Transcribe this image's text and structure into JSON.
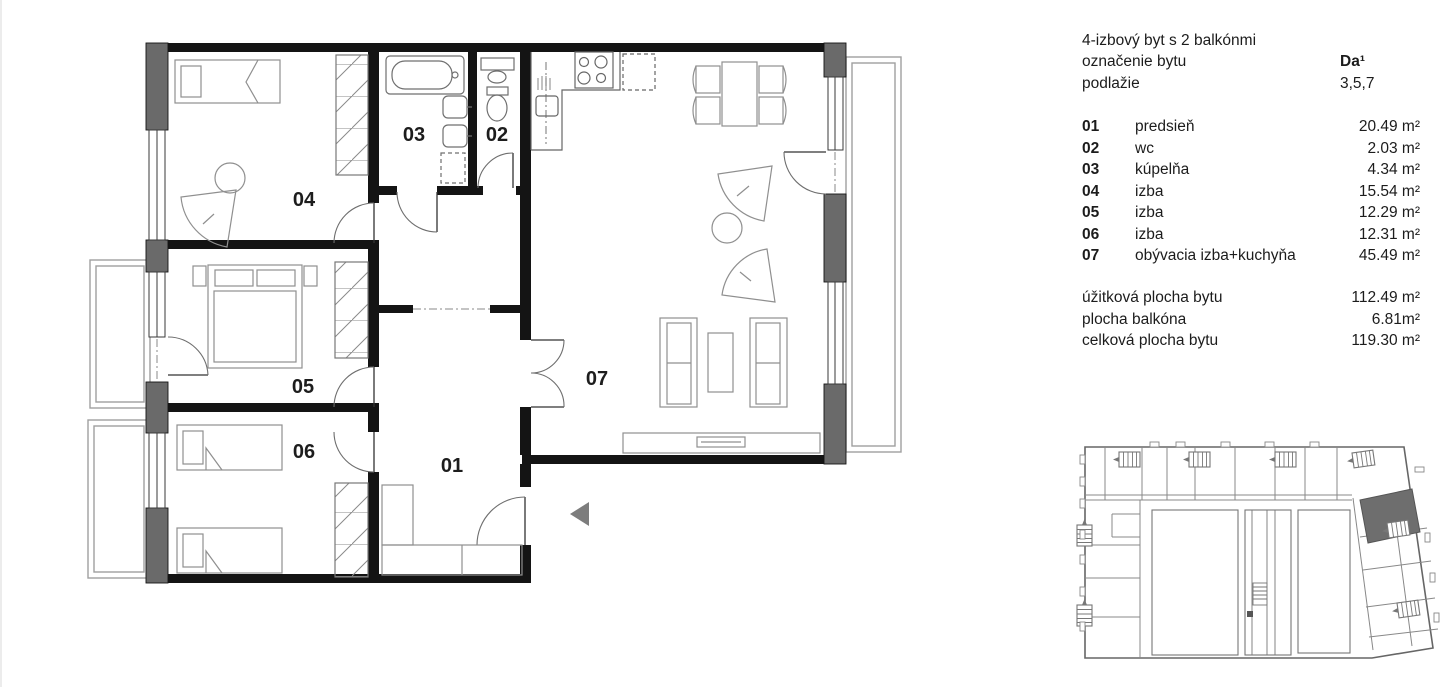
{
  "panel": {
    "title": "4-izbový byt s 2 balkónmi",
    "designation_label": "označenie bytu",
    "designation_value": "Da¹",
    "floor_label": "podlažie",
    "floor_value": "3,5,7",
    "rooms": [
      {
        "num": "01",
        "name": "predsieň",
        "area": "20.49 m²"
      },
      {
        "num": "02",
        "name": "wc",
        "area": "2.03 m²"
      },
      {
        "num": "03",
        "name": "kúpelňa",
        "area": "4.34 m²"
      },
      {
        "num": "04",
        "name": "izba",
        "area": "15.54 m²"
      },
      {
        "num": "05",
        "name": "izba",
        "area": "12.29 m²"
      },
      {
        "num": "06",
        "name": "izba",
        "area": "12.31 m²"
      },
      {
        "num": "07",
        "name": "obývacia izba+kuchyňa",
        "area": "45.49 m²"
      }
    ],
    "totals": [
      {
        "label": "úžitková plocha bytu",
        "value": "112.49 m²"
      },
      {
        "label": "plocha balkóna",
        "value": "6.81m²"
      },
      {
        "label": "celková plocha bytu",
        "value": "119.30 m²"
      }
    ]
  },
  "plan": {
    "labels": {
      "r1": "01",
      "r2": "02",
      "r3": "03",
      "r4": "04",
      "r5": "05",
      "r6": "06",
      "r7": "07"
    }
  },
  "colors": {
    "wall": "#141414",
    "structure_block": "#6a6a6a",
    "furniture_line": "#8f8f8f",
    "highlighted_unit": "#6e6e6e",
    "entry_arrow": "#7d7d7d"
  }
}
